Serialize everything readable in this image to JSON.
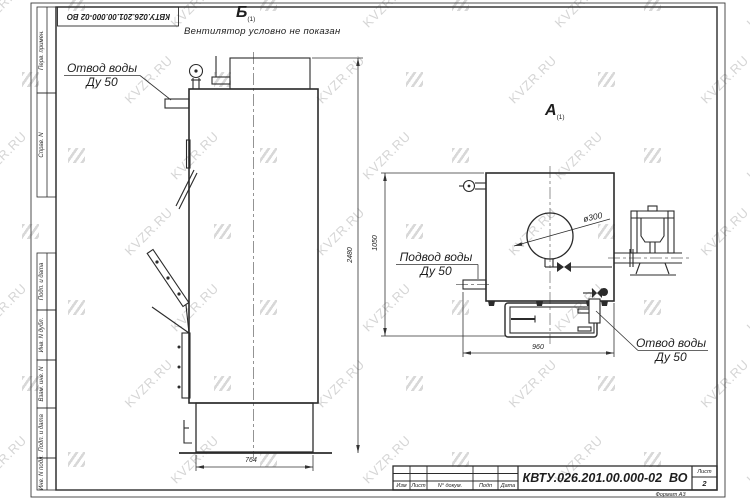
{
  "watermark": {
    "text": "KVZR.RU"
  },
  "stamp_top": {
    "designation": "КВТУ.026.201.00.000-02 ВО"
  },
  "frame": {
    "side_labels": [
      "Перв. примен.",
      "Справ. N",
      "Подп. и дата",
      "Инв. N дубл.",
      "Взам. инв. N",
      "Подп. и дата",
      "Инв. N подл."
    ]
  },
  "views": {
    "b": {
      "label": "Б",
      "sub": "(1)",
      "note": "Вентилятор условно не показан"
    },
    "a": {
      "label": "А",
      "sub": "(1)"
    }
  },
  "callouts": {
    "outlet_left": {
      "line1": "Отвод воды",
      "line2": "Ду 50"
    },
    "inlet": {
      "line1": "Подвод воды",
      "line2": "Ду 50"
    },
    "outlet_right": {
      "line1": "Отвод воды",
      "line2": "Ду 50"
    }
  },
  "dimensions": {
    "front_height": "2480",
    "front_width": "764",
    "side_height": "1050",
    "side_width": "960",
    "flue_diameter": "ø300"
  },
  "title_block": {
    "designation": "КВТУ.026.201.00.000-02  ВО",
    "columns": [
      "Изм",
      "Лист",
      "N° докум.",
      "Подп",
      "Дата"
    ],
    "sheet_label": "Лист",
    "sheet_number": "2",
    "format_label": "Формат А3"
  }
}
